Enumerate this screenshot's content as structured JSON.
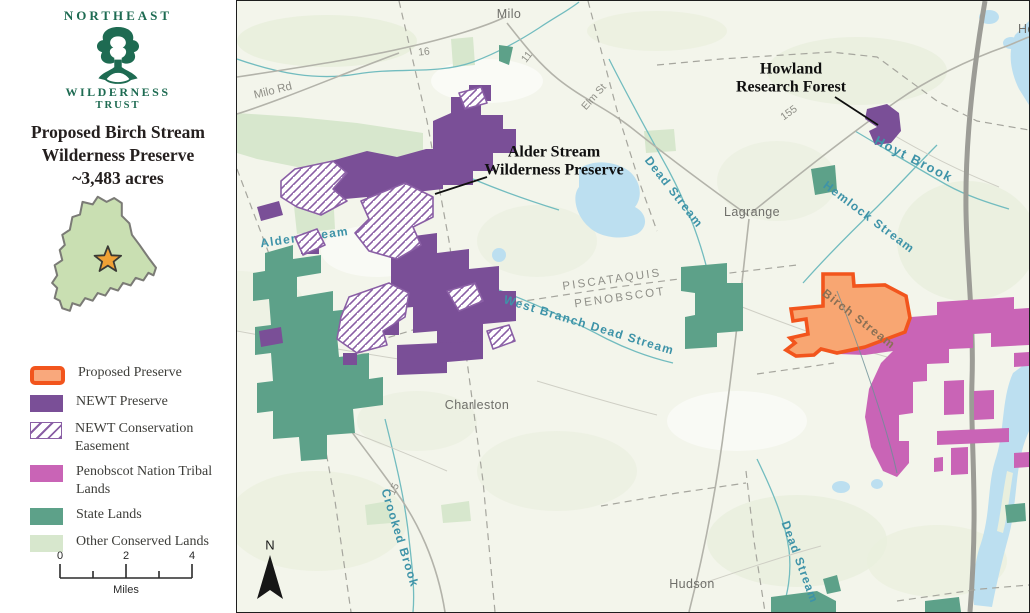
{
  "sidebar": {
    "org": {
      "line1": "NORTHEAST",
      "line2": "WILDERNESS",
      "line3": "TRUST"
    },
    "title": {
      "line1": "Proposed Birch Stream",
      "line2": "Wilderness Preserve",
      "line3": "~3,483 acres"
    },
    "legend": {
      "items": [
        {
          "label": "Proposed Preserve"
        },
        {
          "label": "NEWT Preserve"
        },
        {
          "label": "NEWT Conservation Easement"
        },
        {
          "label": "Penobscot Nation Tribal Lands"
        },
        {
          "label": "State Lands"
        },
        {
          "label": "Other Conserved Lands"
        }
      ]
    },
    "scalebar": {
      "t0": "0",
      "t2": "2",
      "t4": "4",
      "unit": "Miles"
    }
  },
  "map": {
    "north_label": "N",
    "towns": {
      "milo": "Milo",
      "lagrange": "Lagrange",
      "charleston": "Charleston",
      "hudson": "Hudson",
      "howland": "Howland"
    },
    "roads": {
      "r16": "16",
      "r11": "11",
      "elm": "Elm St",
      "milo_rd": "Milo Rd",
      "r155": "155",
      "r15": "15"
    },
    "streams": {
      "alder": "Alder Stream",
      "dead_upper": "Dead Stream",
      "hemlock": "Hemlock Stream",
      "hoyt": "Hoyt Brook",
      "west_branch": "West Branch Dead Stream",
      "crooked": "Crooked Brook",
      "dead_lower": "Dead Stream",
      "birch": "Birch Stream"
    },
    "counties": {
      "piscataquis": "PISCATAQUIS",
      "penobscot": "PENOBSCOT"
    },
    "annotations": {
      "howland": {
        "line1": "Howland",
        "line2": "Research Forest"
      },
      "alder": {
        "line1": "Alder Stream",
        "line2": "Wilderness Preserve"
      }
    }
  },
  "colors": {
    "proposed_border": "#f2551d",
    "proposed_fill": "#f8a672",
    "newt_preserve": "#7a4f97",
    "easement_line": "#8a5fa5",
    "penobscot_lands": "#c964b6",
    "state_lands": "#5da189",
    "other_conserved": "#d7e7cd",
    "stream_label": "#3e93a8",
    "water_line": "#72bcbf",
    "lake_fill": "#bcdff0",
    "logo_green": "#1e6b52",
    "star_orange": "#f0a135"
  }
}
